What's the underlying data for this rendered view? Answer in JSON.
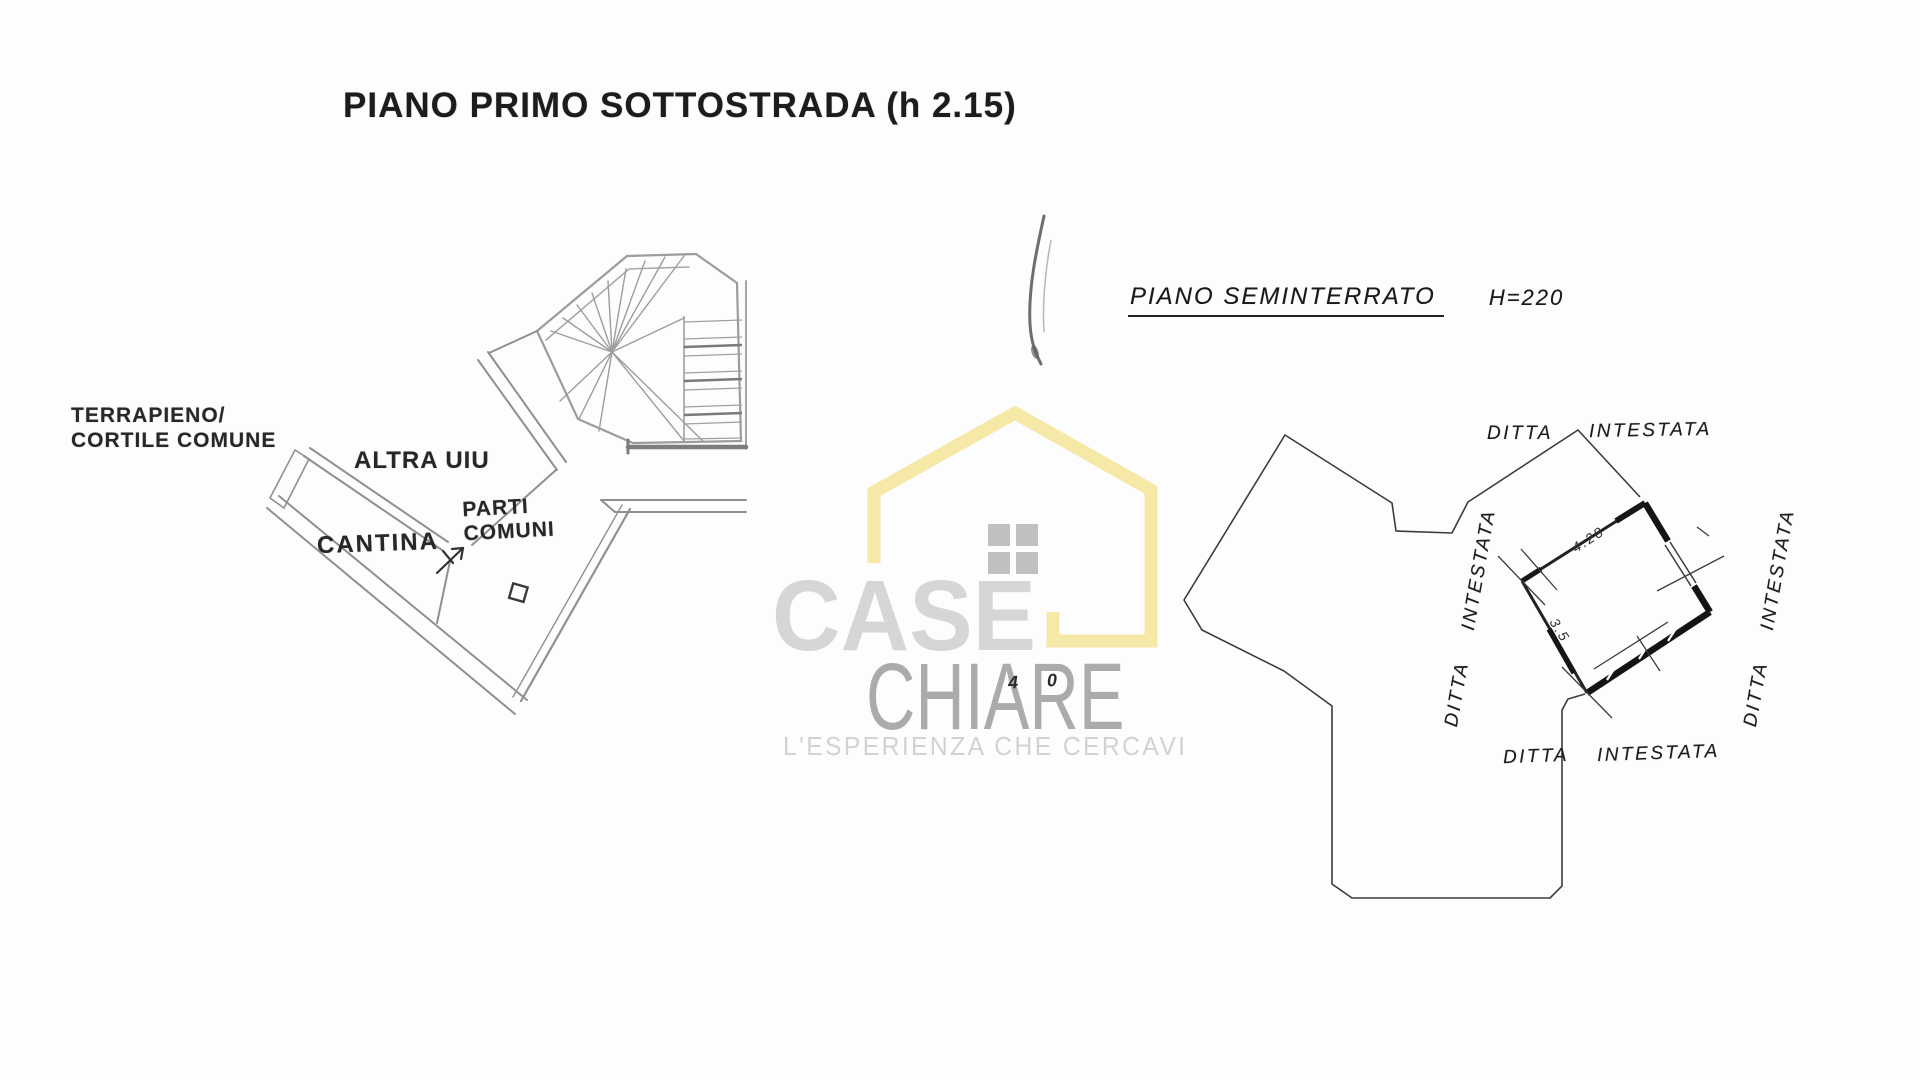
{
  "document": {
    "left_plan": {
      "title": "PIANO PRIMO SOTTOSTRADA (h 2.15)",
      "labels": {
        "terrapieno_line1": "TERRAPIENO/",
        "terrapieno_line2": "CORTILE COMUNE",
        "altra_uiu": "ALTRA UIU",
        "cantina": "CANTINA",
        "parti_comuni_line1": "PARTI",
        "parti_comuni_line2": "COMUNI"
      }
    },
    "right_plan": {
      "title": "PIANO SEMINTERRATO",
      "height_note": "H=220",
      "boundary_labels": {
        "top": {
          "word1": "DITTA",
          "word2": "INTESTATA"
        },
        "left": {
          "word1": "DITTA",
          "word2": "INTESTATA"
        },
        "right": {
          "word1": "DITTA",
          "word2": "INTESTATA"
        },
        "bottom": {
          "word1": "DITTA",
          "word2": "INTESTATA"
        }
      },
      "dimensions": {
        "top_edge": "4.28",
        "left_edge": "3.5"
      },
      "stray_mark": "4 0"
    },
    "watermark": {
      "brand_word1": "CASE",
      "brand_word2": "CHIARE",
      "tagline": "L'ESPERIENZA CHE CERCAVI",
      "colors": {
        "house_outline": "#F5E6A0",
        "window": "#B6B6B6",
        "brand_word1_color": "#D6D6D6",
        "brand_word2_color": "#ABABAB",
        "tagline_color": "#D2D2D2"
      }
    },
    "colors": {
      "left_plan_lines": "#8F8F8F",
      "right_plan_lines": "#3C3C3C",
      "thick_walls": "#161616",
      "text": "#1F1F1F"
    }
  }
}
